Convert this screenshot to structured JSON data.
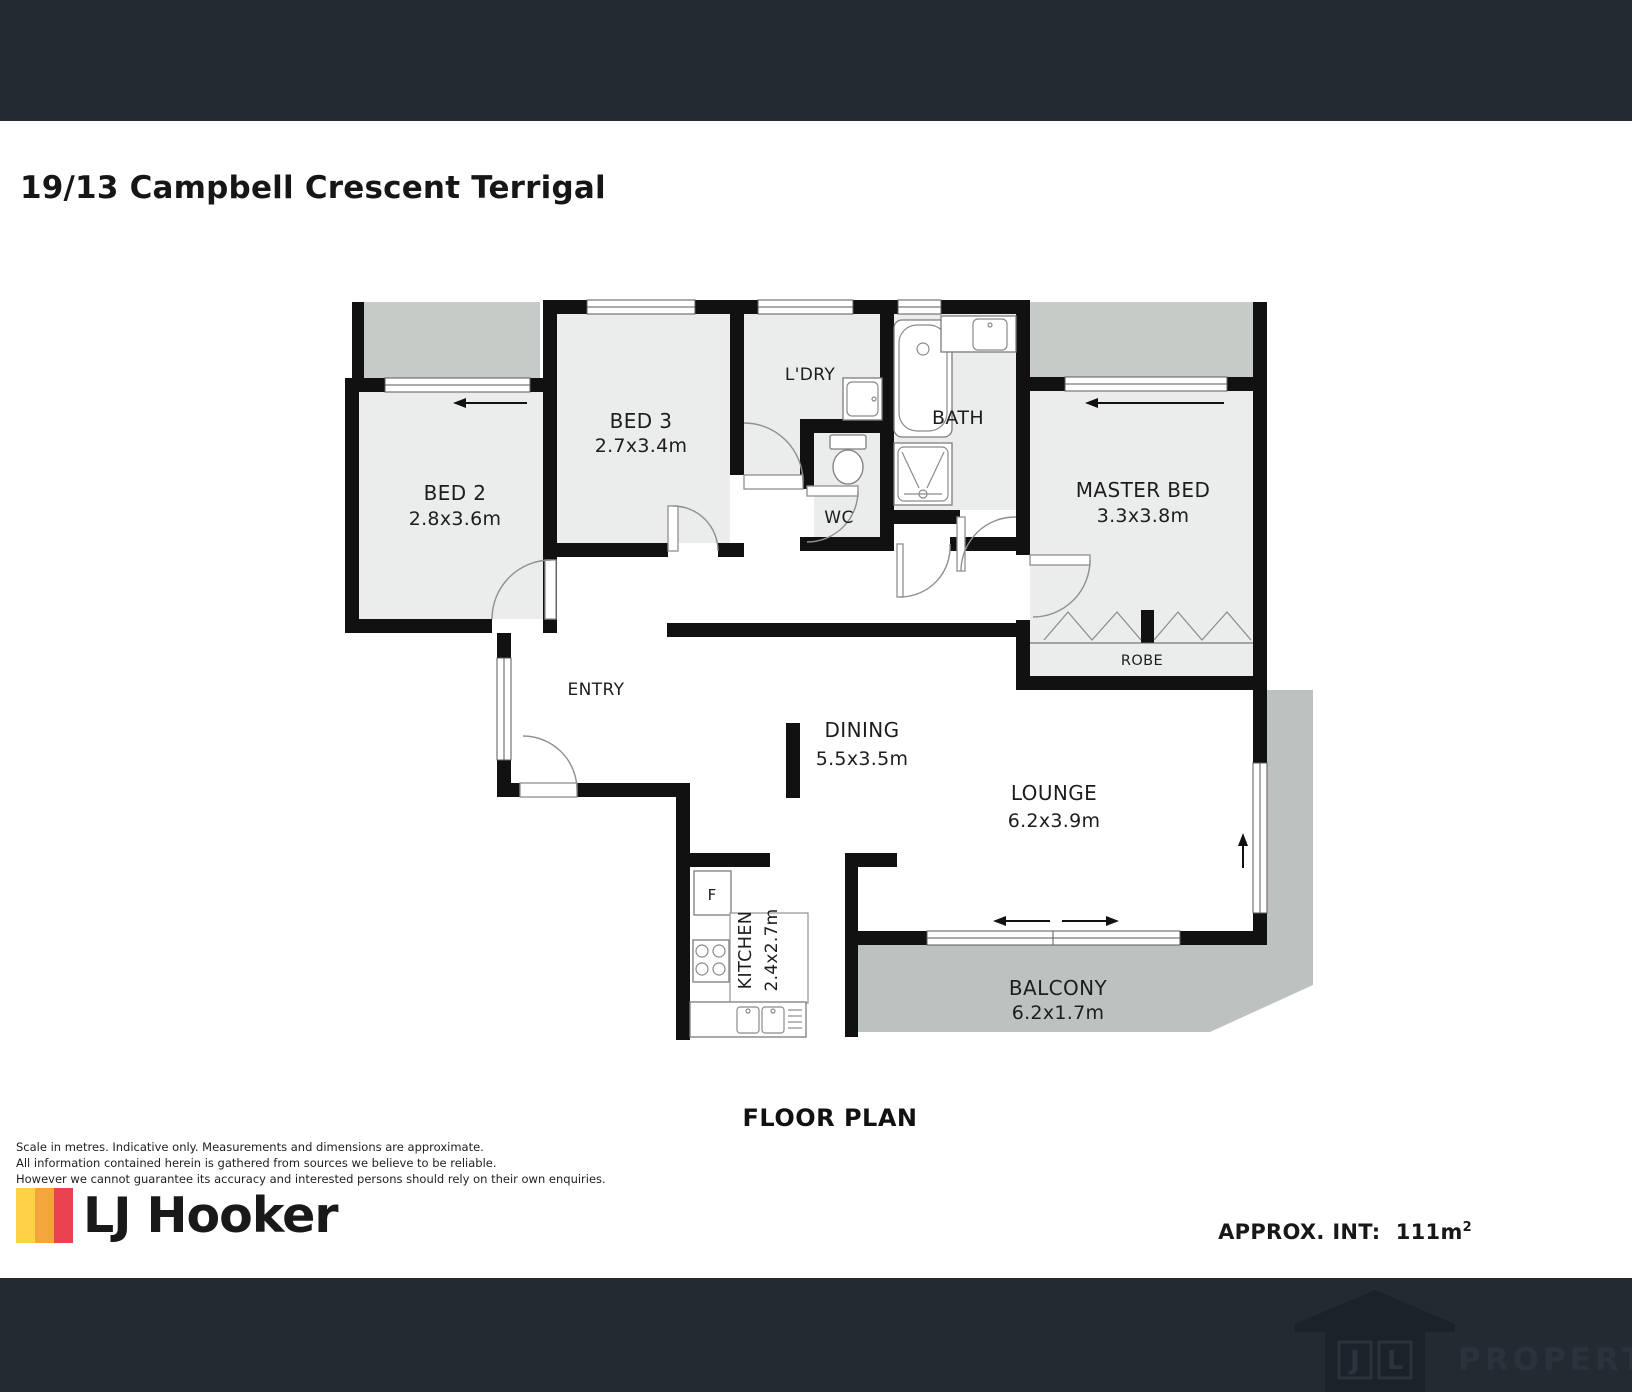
{
  "title": "19/13 Campbell Crescent Terrigal",
  "plan": {
    "rooms": {
      "bed2": {
        "name": "BED 2",
        "dims": "2.8x3.6m"
      },
      "bed3": {
        "name": "BED 3",
        "dims": "2.7x3.4m"
      },
      "ldry": {
        "name": "L'DRY"
      },
      "wc": {
        "name": "WC"
      },
      "bath": {
        "name": "BATH"
      },
      "master": {
        "name": "MASTER BED",
        "dims": "3.3x3.8m"
      },
      "robe": {
        "name": "ROBE"
      },
      "entry": {
        "name": "ENTRY"
      },
      "dining": {
        "name": "DINING",
        "dims": "5.5x3.5m"
      },
      "lounge": {
        "name": "LOUNGE",
        "dims": "6.2x3.9m"
      },
      "kitchen": {
        "name": "KITCHEN",
        "dims": "2.4x2.7m"
      },
      "balcony": {
        "name": "BALCONY",
        "dims": "6.2x1.7m"
      },
      "fridge": {
        "name": "F"
      }
    },
    "colors": {
      "wall": "#111111",
      "room_fill": "#ebecec",
      "outdoor": "#c6cbc7",
      "balcony": "#bcc2bf",
      "header_bar": "#232a32"
    }
  },
  "caption": "FLOOR PLAN",
  "disclaimer": [
    "Scale in metres. Indicative only. Measurements and dimensions are approximate.",
    "All information contained herein is gathered from sources we believe to be reliable.",
    "However we cannot guarantee its accuracy and interested persons should rely on their own enquiries."
  ],
  "brand": {
    "name": "LJ Hooker",
    "stripe_colors": [
      "#FFD246",
      "#F4A63C",
      "#E8434E"
    ]
  },
  "approx": {
    "label": "APPROX. INT:",
    "value": "111m",
    "sup": "2"
  },
  "footer": {
    "watermark": "PROPERTY",
    "initial_1": "J",
    "initial_2": "L"
  }
}
